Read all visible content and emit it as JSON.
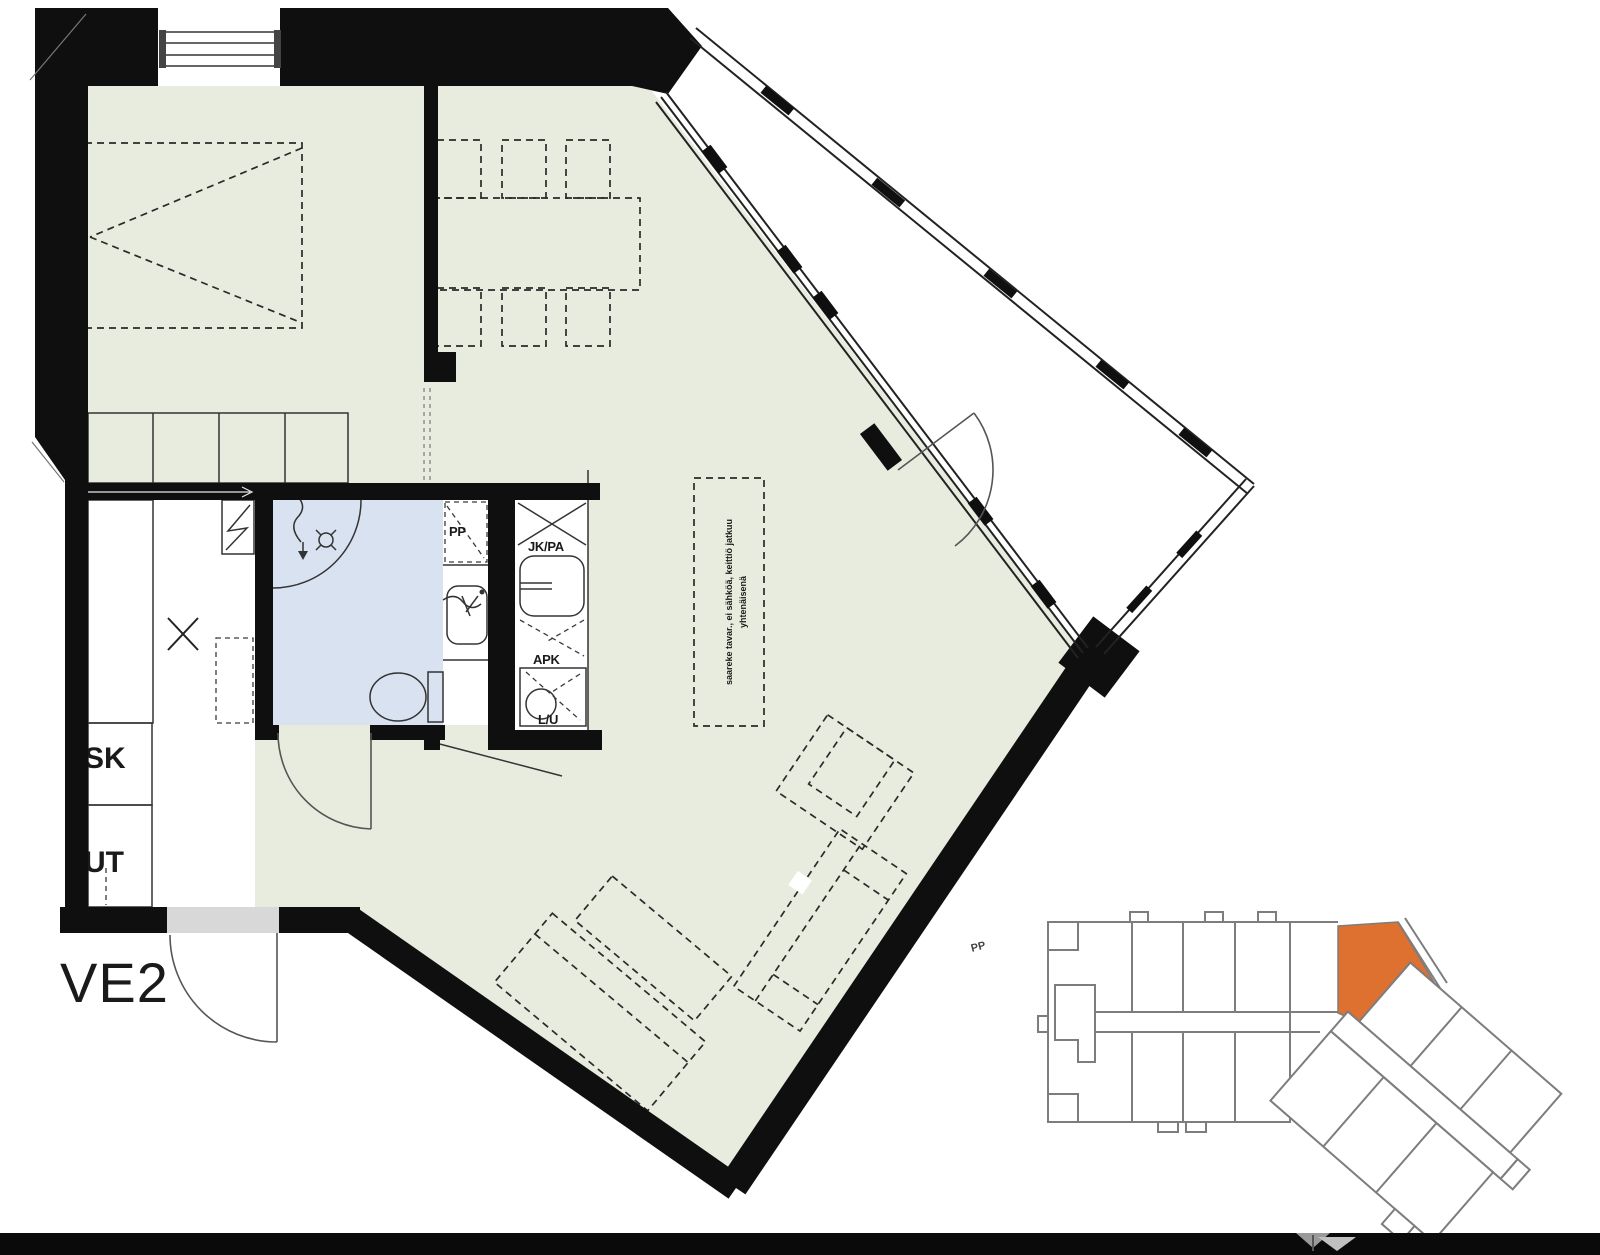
{
  "plan": {
    "variant_label": "VE2",
    "closet_labels": {
      "sk": "SK",
      "ut": "UT"
    },
    "bathroom": {
      "washer_reservation_label": "PP"
    },
    "kitchen": {
      "fridge_freezer_label": "JK/PA",
      "dishwasher_label": "APK",
      "stove_oven_label": "L/U"
    },
    "island_note": {
      "line1": "saareke tavar., ei sähköä, keittiö jatkuu",
      "line2": "yhtenäisenä"
    }
  },
  "site_plan": {
    "bike_parking_label": "PP"
  },
  "colors": {
    "floor": "#E7ECDF",
    "wet_room": "#D9E2F0",
    "wall": "#0F0F0F",
    "unit_highlight": "#DE7030",
    "outline_gray": "#7D7D7D",
    "threshold": "#D8D8D8"
  }
}
